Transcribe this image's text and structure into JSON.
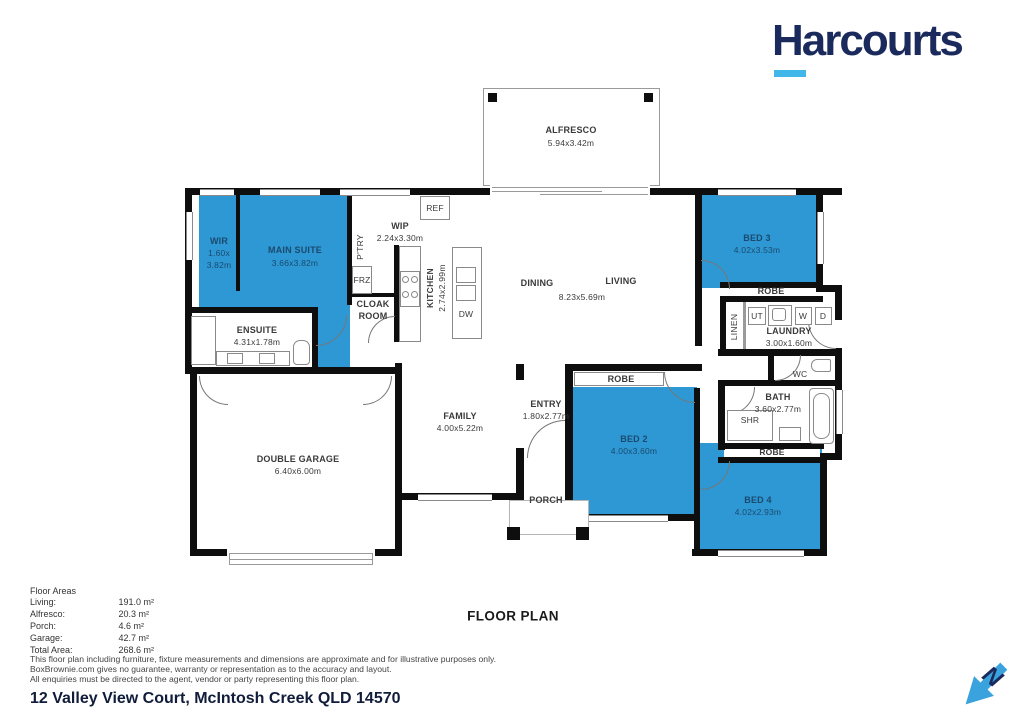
{
  "brand": {
    "logo_text": "Harcourts",
    "navy": "#1b2a5c",
    "underline_blue": "#41b6e8"
  },
  "title": "FLOOR PLAN",
  "address": "12 Valley View Court, McIntosh Creek QLD 14570",
  "compass": {
    "letter": "N"
  },
  "colors": {
    "room_blue": "#2d98d4",
    "wall_black": "#0e0e0e",
    "label_on_blue": "#1c4a6e"
  },
  "floor_areas": {
    "heading": "Floor Areas",
    "rows": [
      {
        "label": "Living:",
        "value": "191.0 m²"
      },
      {
        "label": "Alfresco:",
        "value": "20.3 m²"
      },
      {
        "label": "Porch:",
        "value": "4.6 m²"
      },
      {
        "label": "Garage:",
        "value": "42.7 m²"
      },
      {
        "label": "Total Area:",
        "value": "268.6 m²"
      }
    ]
  },
  "disclaimer": {
    "line1": "This floor plan including furniture, fixture measurements and dimensions are approximate and for illustrative purposes only.",
    "line2": "BoxBrownie.com gives no guarantee, warranty or representation as to the accuracy and layout.",
    "line3": "All enquiries must be directed to the agent, vendor or party representing this floor plan."
  },
  "plan": {
    "alfresco": {
      "name": "ALFRESCO",
      "dims": "5.94x3.42m"
    },
    "wir": {
      "name": "WIR",
      "dims1": "1.60x",
      "dims2": "3.82m"
    },
    "main_suite": {
      "name": "MAIN SUITE",
      "dims": "3.66x3.82m"
    },
    "ptry": "P'TRY",
    "wip": {
      "name": "WIP",
      "dims": "2.24x3.30m"
    },
    "ref": "REF",
    "frz": "FRZ",
    "cloak1": "CLOAK",
    "cloak2": "ROOM",
    "kitchen": {
      "name": "KITCHEN",
      "dims": "2.74x2.99m"
    },
    "dw": "DW",
    "dining": "DINING",
    "living": "LIVING",
    "dining_living_dims": "8.23x5.69m",
    "bed3": {
      "name": "BED 3",
      "dims": "4.02x3.53m"
    },
    "robe3": "ROBE",
    "linen": "LINEN",
    "ut": "UT",
    "w": "W",
    "d": "D",
    "laundry": {
      "name": "LAUNDRY",
      "dims": "3.00x1.60m"
    },
    "ensuite": {
      "name": "ENSUITE",
      "dims": "4.31x1.78m"
    },
    "family": {
      "name": "FAMILY",
      "dims": "4.00x5.22m"
    },
    "entry": {
      "name": "ENTRY",
      "dims": "1.80x2.77m"
    },
    "bed2": {
      "name": "BED 2",
      "dims": "4.00x3.60m"
    },
    "robe2": "ROBE",
    "wc": "WC",
    "bath": {
      "name": "BATH",
      "dims": "3.60x2.77m"
    },
    "shr": "SHR",
    "robe4": "ROBE",
    "bed4": {
      "name": "BED 4",
      "dims": "4.02x2.93m"
    },
    "garage": {
      "name": "DOUBLE GARAGE",
      "dims": "6.40x6.00m"
    },
    "porch": "PORCH"
  }
}
